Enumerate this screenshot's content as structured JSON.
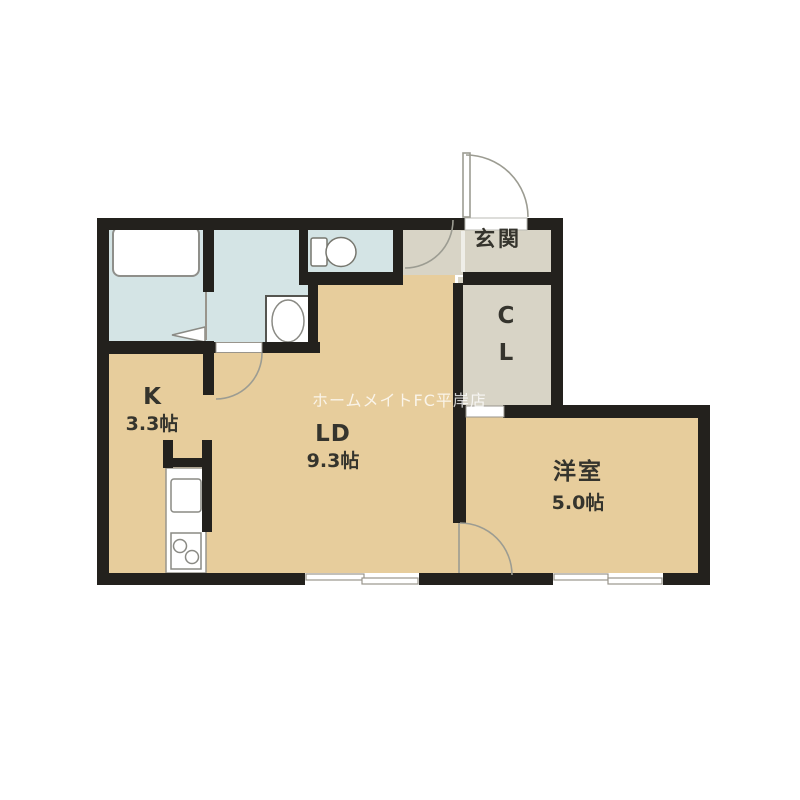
{
  "plan": {
    "type": "apartment-floor-plan",
    "watermark": "ホームメイトFC平岸店",
    "rooms": {
      "entrance": {
        "label": "玄関"
      },
      "closet": {
        "label_line1": "C",
        "label_line2": "L"
      },
      "kitchen": {
        "label": "K",
        "size": "3.3帖"
      },
      "living_dining": {
        "label": "LD",
        "size": "9.3帖"
      },
      "western_room": {
        "label": "洋室",
        "size": "5.0帖"
      }
    },
    "fixtures": [
      "bathtub",
      "washbasin",
      "toilet",
      "kitchen-sink",
      "gas-stove",
      "folding-bath-door",
      "entrance-door",
      "sliding-windows"
    ],
    "colors": {
      "wall": "#23211d",
      "floor_tan": "#e7cd9c",
      "floor_wet": "#d4e4e5",
      "floor_gray": "#d8d4c6",
      "arc": "#9c9c92",
      "fixture_stroke": "#8a8a84",
      "label_text": "#35342d"
    }
  }
}
